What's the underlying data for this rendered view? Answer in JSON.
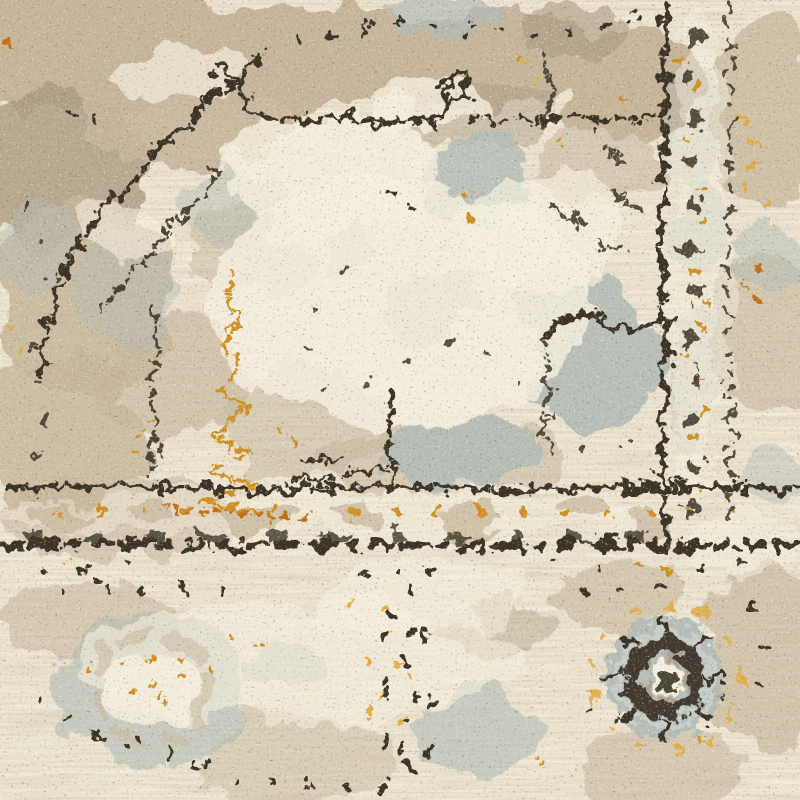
{
  "scene": {
    "type": "photograph-closeup",
    "subject": "Close-up of a distressed vintage-style area rug in cream, beige, gray-blue and charcoal with gold accents",
    "elements": {
      "field": "ivory cream wool pile with horizontal weave streaks and beige-taupe faded patches",
      "medallion_outline": "broken stepped charcoal lines across the upper left and center",
      "vertical_border": "double charcoal guard stripes with dark chain ornament and gold flecks, right side",
      "horizontal_border": "double charcoal guard stripes with beige-and-gold ornament band, lower middle",
      "rosette": "round gray-blue rosette medallion with charcoal ring and cream center, lower right",
      "wreath": "faded gray-blue wreath motif with gold flecks, lower left",
      "tower_motif": "burnt-orange zigzag motif descending the left-center field",
      "speckles": "scattered charcoal flecks throughout the pile"
    }
  },
  "palette": {
    "base_cream": "#eae1cd",
    "cream_light": "#f5efde",
    "taupe": "#c6b59a",
    "taupe_dark": "#ab9a80",
    "gray_blue": "#b2bbb6",
    "gray_blue_light": "#c9d0cb",
    "charcoal": "#3a3326",
    "charcoal_soft": "#5c5140",
    "gold": "#cf9022",
    "orange": "#c06f15",
    "amber": "#e0ac45"
  }
}
